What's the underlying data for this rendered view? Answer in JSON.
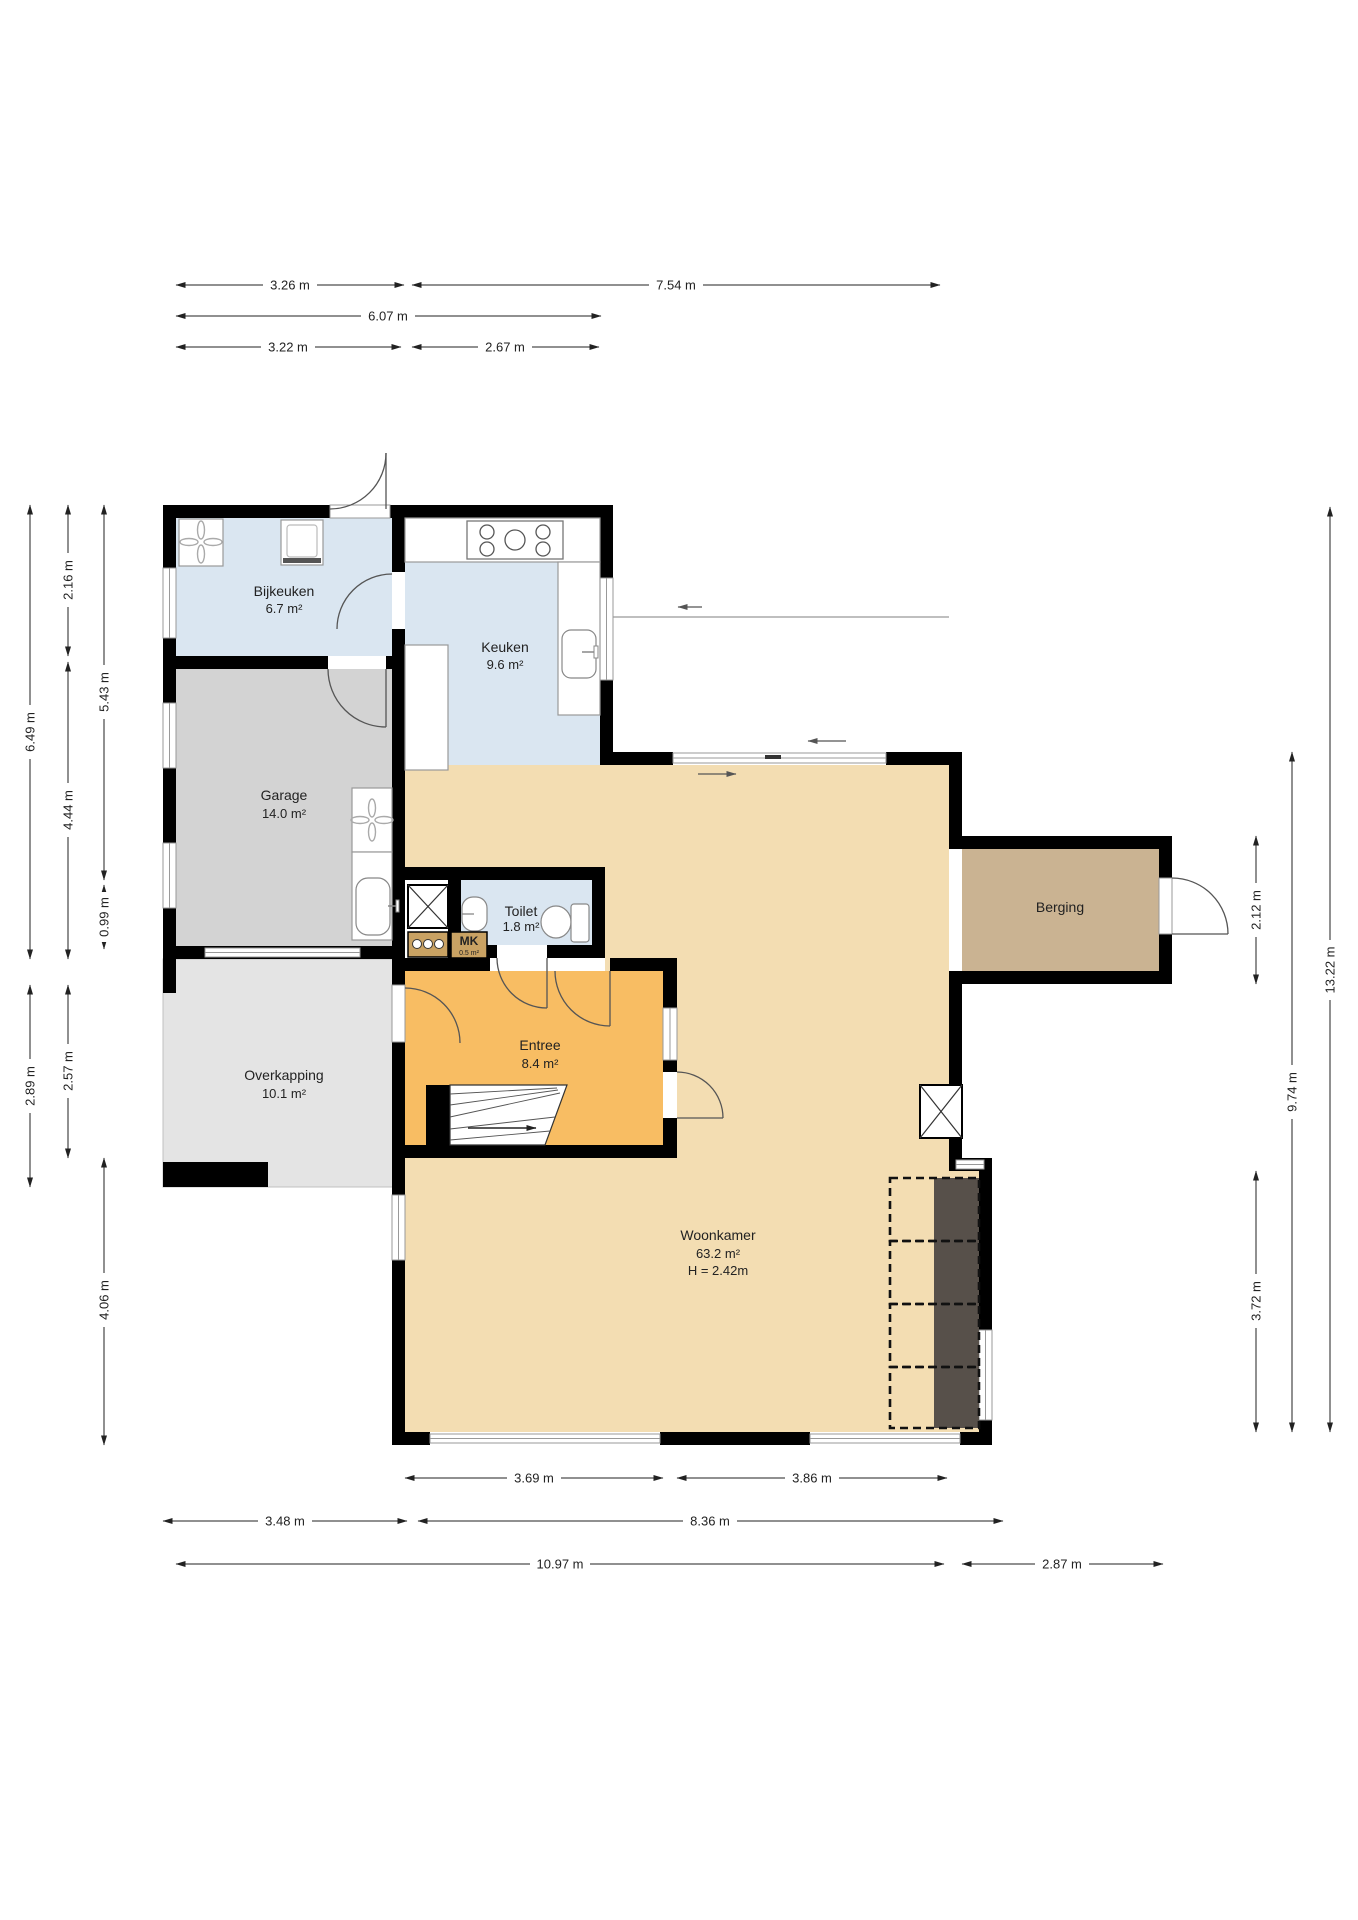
{
  "plan": {
    "title": "floor-plan",
    "rooms": {
      "bijkeuken": {
        "name": "Bijkeuken",
        "area": "6.7 m²"
      },
      "keuken": {
        "name": "Keuken",
        "area": "9.6 m²"
      },
      "garage": {
        "name": "Garage",
        "area": "14.0 m²"
      },
      "overkapping": {
        "name": "Overkapping",
        "area": "10.1 m²"
      },
      "toilet": {
        "name": "Toilet",
        "area": "1.8 m²"
      },
      "mk": {
        "name": "MK",
        "area": "0.5 m²"
      },
      "entree": {
        "name": "Entree",
        "area": "8.4 m²"
      },
      "woonkamer": {
        "name": "Woonkamer",
        "area": "63.2 m²",
        "ceiling_height": "H = 2.42m"
      },
      "berging": {
        "name": "Berging"
      }
    },
    "dimensions": {
      "top": {
        "w326": "3.26 m",
        "w754": "7.54 m",
        "w607": "6.07 m",
        "w322": "3.22 m",
        "w267": "2.67 m"
      },
      "left": {
        "h649": "6.49 m",
        "h216": "2.16 m",
        "h444": "4.44 m",
        "h543": "5.43 m",
        "h099": "0.99 m",
        "h289": "2.89 m",
        "h257": "2.57 m",
        "h406": "4.06 m"
      },
      "right": {
        "h212": "2.12 m",
        "h974": "9.74 m",
        "h1322": "13.22 m",
        "h372": "3.72 m"
      },
      "bottom": {
        "w369": "3.69 m",
        "w386": "3.86 m",
        "w348": "3.48 m",
        "w836": "8.36 m",
        "w1097": "10.97 m",
        "w287": "2.87 m"
      }
    },
    "colors": {
      "wall": "#000000",
      "wet_room": "#dae6f1",
      "garage": "#d3d3d3",
      "overkapping": "#e4e4e4",
      "entree": "#f8bd63",
      "living": "#f3ddb2",
      "berging": "#cab392",
      "closet": "#c9a263",
      "dark_strip": "#57504a"
    }
  }
}
